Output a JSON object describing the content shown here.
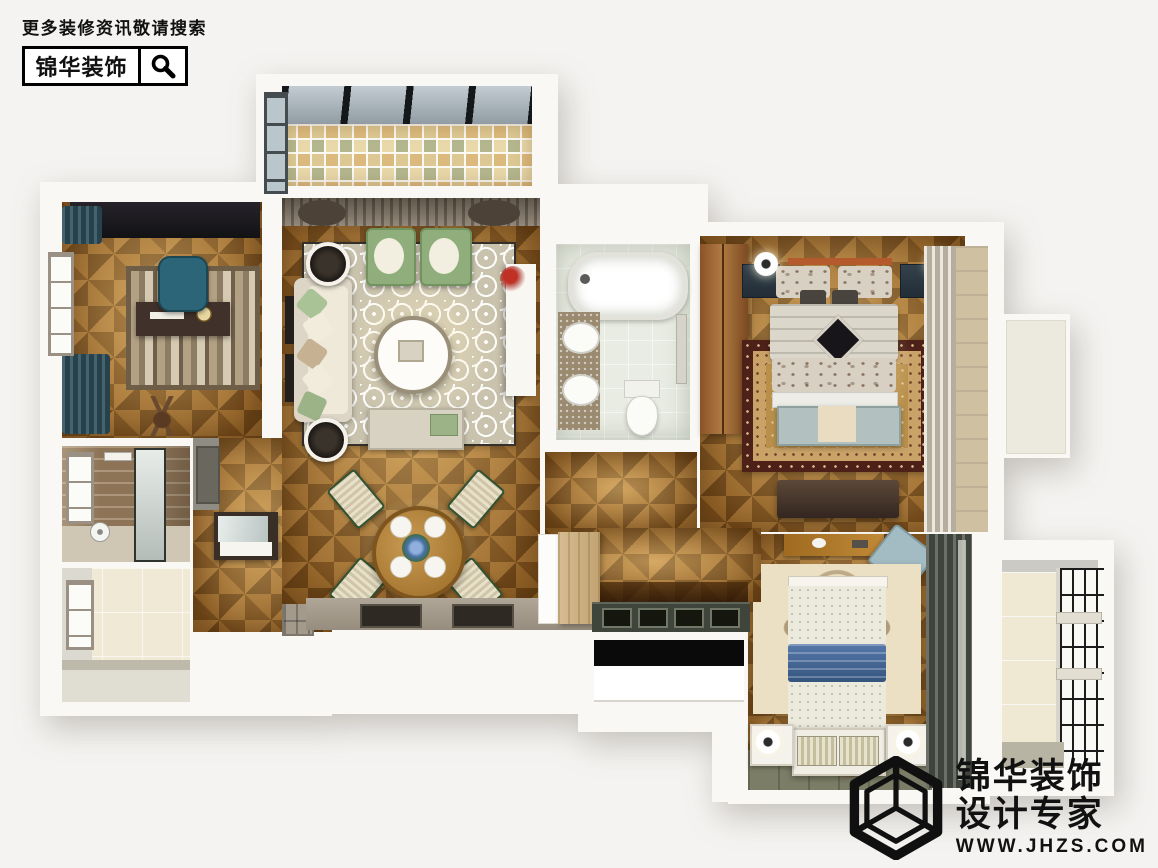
{
  "header": {
    "tagline": "更多装修资讯敬请搜索",
    "brand": "锦华装饰",
    "icons": {
      "search": "magnifier"
    }
  },
  "watermark": {
    "brand": "锦华装饰",
    "subtitle": "设计专家",
    "website": "WWW.JHZS.COM",
    "icons": {
      "logo": "wireframe-cube"
    }
  },
  "palette": {
    "page_background": "#f4f3f1",
    "wall": "#f9f8f5",
    "parquet_wood": "#ab752f",
    "mosaic_tile": "#e6d6a8",
    "bath_tile": "#e9ece2",
    "ink": "#111111",
    "living_rug": "#c9c2ad",
    "persian_rug": "#4d2018",
    "armchair_green": "#8fae7b",
    "office_chair_teal": "#2c6577",
    "blanket_blue": "#44659a",
    "curtain_teal": "#27424c",
    "olive_floor": "#7b7d66"
  }
}
